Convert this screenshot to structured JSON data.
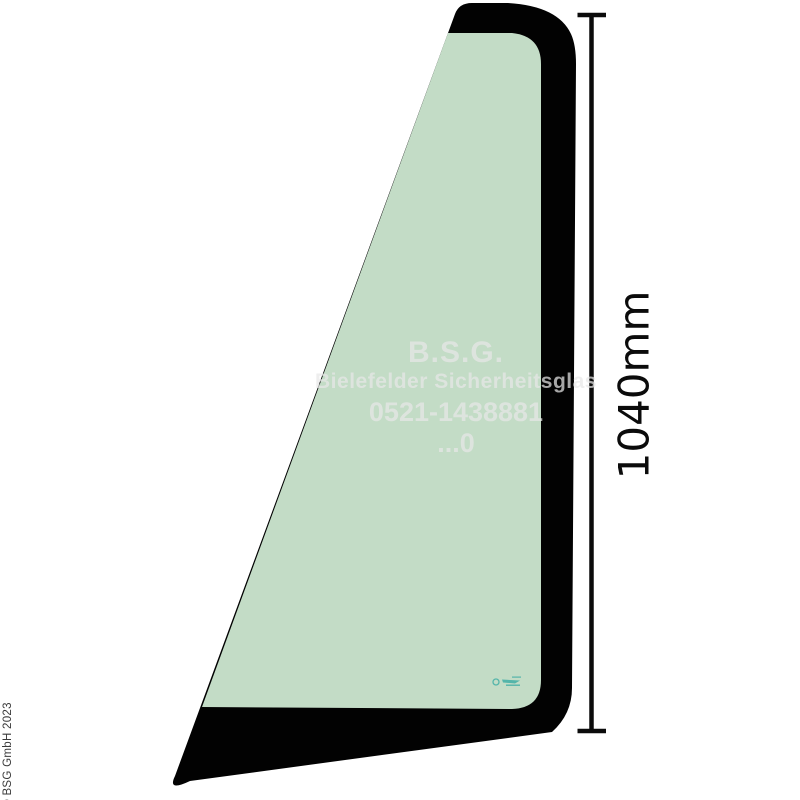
{
  "glass": {
    "colors": {
      "glass_green": "#c3dcc6",
      "band_black": "#020202",
      "background": "#ffffff",
      "stamp_teal": "#2fa9a1"
    }
  },
  "watermark": {
    "color": "rgba(232,232,232,0.72)",
    "lines": {
      "l1": "B.S.G.",
      "l2": "Bielefelder Sicherheitsglas",
      "l3": "0521-1438881",
      "l4": "...0"
    }
  },
  "dimension": {
    "label": "1040mm",
    "color": "#0b0b0b"
  },
  "copyright": {
    "text": "© BSG GmbH 2023",
    "color": "#3a3a3a"
  }
}
